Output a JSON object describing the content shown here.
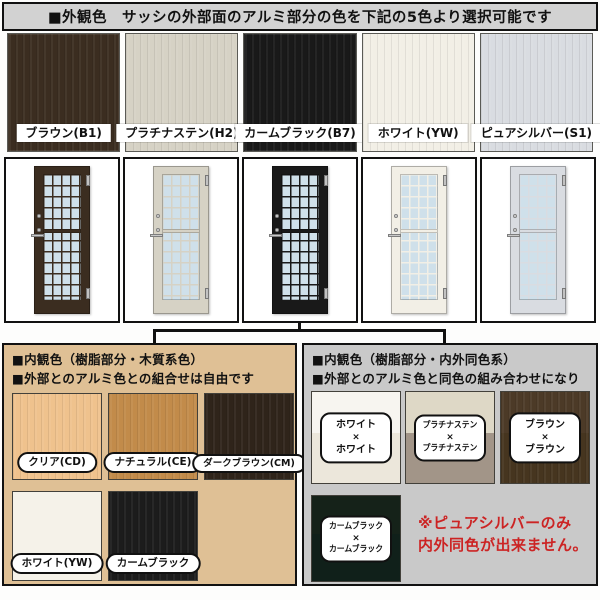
{
  "title": "■外観色　サッシの外部面のアルミ部分の色を下記の5色より選択可能です",
  "door_glass_color": "#cfe0ea",
  "exterior": {
    "colors": [
      {
        "label": "ブラウン(B1)",
        "hex": "#3b2d20"
      },
      {
        "label": "プラチナステン(H2)",
        "hex": "#d6d2c5"
      },
      {
        "label": "カームブラック(B7)",
        "hex": "#191919"
      },
      {
        "label": "ホワイト(YW)",
        "hex": "#f2efe6"
      },
      {
        "label": "ピュアシルバー(S1)",
        "hex": "#d9dce1"
      }
    ]
  },
  "interior_wood": {
    "bg": "#dfc095",
    "heading_line1": "■内観色（樹脂部分・木質系色）",
    "heading_line2": "■外部とのアルミ色との組合せは自由です",
    "colors": [
      {
        "label": "クリア(CD)",
        "hex": "#efc28d"
      },
      {
        "label": "ナチュラル(CE)",
        "hex": "#c28b4a"
      },
      {
        "label": "ダークブラウン(CM)",
        "hex": "#2f241a"
      },
      {
        "label": "ホワイト(YW)",
        "hex": "#f5f2e9"
      },
      {
        "label": "カームブラック",
        "hex": "#1c1c1c"
      }
    ]
  },
  "interior_same": {
    "bg": "#c9c9c9",
    "heading_line1": "■内観色（樹脂部分・内外同色系）",
    "heading_line2": "■外部とのアルミ色と同色の組み合わせになります",
    "combos": [
      {
        "top": "ホワイト",
        "sep": "×",
        "bottom": "ホワイト",
        "hex_top": "#f7f5f0",
        "hex_bottom": "#ece7db"
      },
      {
        "top": "プラチナステン",
        "sep": "×",
        "bottom": "プラチナステン",
        "hex_top": "#ded8c6",
        "hex_bottom": "#a29588"
      },
      {
        "top": "ブラウン",
        "sep": "×",
        "bottom": "ブラウン",
        "hex_top": "#4c3a27",
        "hex_bottom": "#46351f"
      },
      {
        "top": "カームブラック",
        "sep": "×",
        "bottom": "カームブラック",
        "hex_top": "#152219",
        "hex_bottom": "#10201a"
      }
    ],
    "note_line1": "※ピュアシルバーのみ",
    "note_line2": "内外同色が出来ません。",
    "note_color": "#cc2424"
  }
}
